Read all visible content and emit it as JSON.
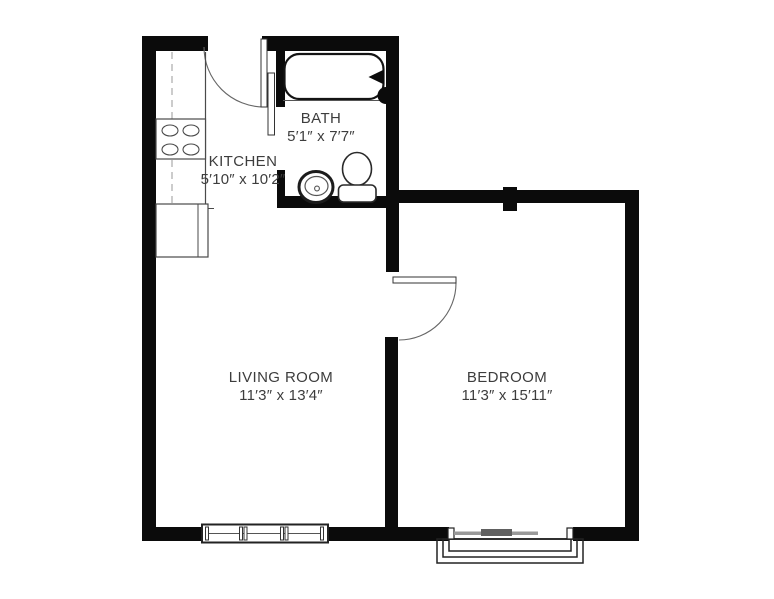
{
  "rooms": {
    "bath": {
      "name": "BATH",
      "dimensions": "5′1″ x 7′7″"
    },
    "kitchen": {
      "name": "KITCHEN",
      "dimensions": "5′10″ x 10′2″"
    },
    "living_room": {
      "name": "LIVING ROOM",
      "dimensions": "11′3″ x 13′4″"
    },
    "bedroom": {
      "name": "BEDROOM",
      "dimensions": "11′3″ x 15′11″"
    }
  },
  "colors": {
    "wall": "#0b0b0b",
    "fixture_line": "#4a4a4a",
    "door_arc": "#666666",
    "text": "#3d3d3d",
    "window_glass": "#999999",
    "window_slider": "#606060",
    "background": "#ffffff"
  }
}
